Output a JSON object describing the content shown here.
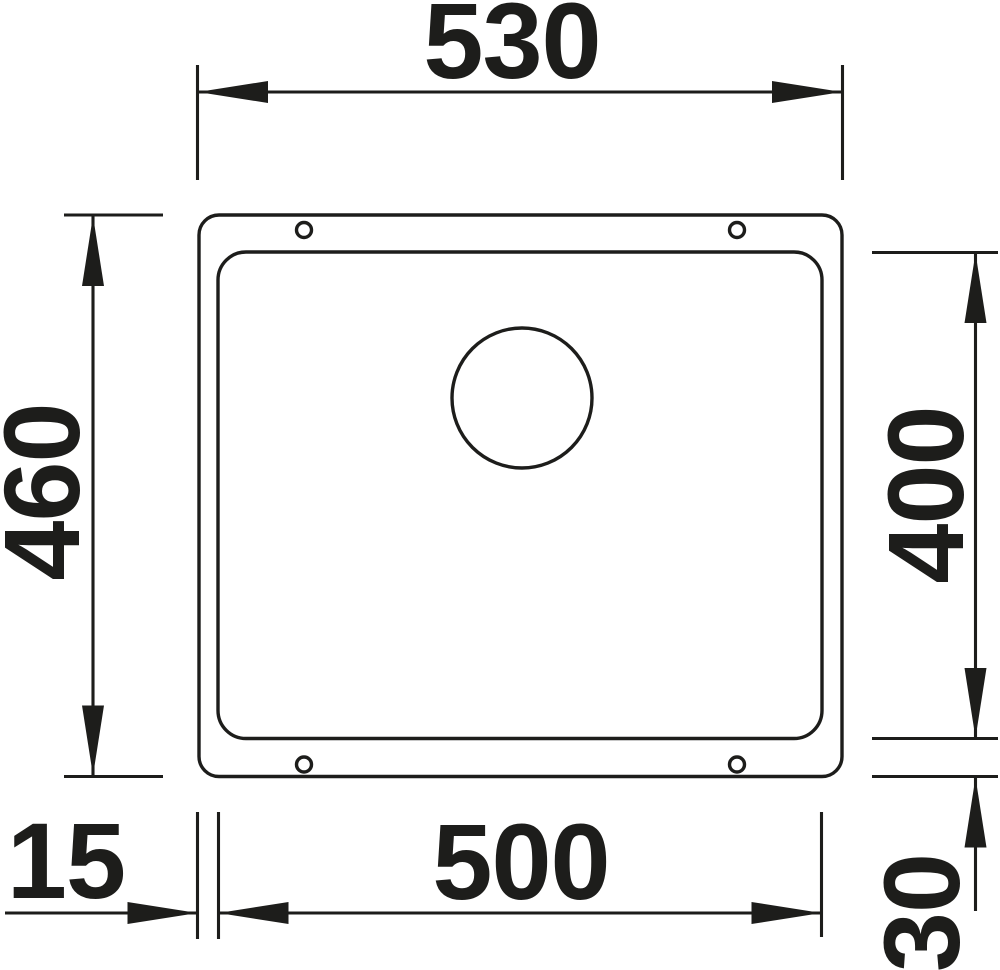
{
  "diagram": {
    "kind": "technical-dimension-drawing",
    "subject": "rectangular sink with bowl and drain, top view",
    "colors": {
      "line": "#1d1d1b",
      "background": "#ffffff"
    },
    "dimensions": {
      "outer_width": {
        "label": "530",
        "orientation": "horizontal",
        "position": "top"
      },
      "outer_height": {
        "label": "460",
        "orientation": "vertical",
        "position": "left"
      },
      "bowl_height": {
        "label": "400",
        "orientation": "vertical",
        "position": "right"
      },
      "bowl_width": {
        "label": "500",
        "orientation": "horizontal",
        "position": "bottom"
      },
      "rim_offset_left": {
        "label": "15",
        "orientation": "horizontal",
        "position": "bottom-left"
      },
      "rim_offset_bottom": {
        "label": "30",
        "orientation": "vertical",
        "position": "bottom-right"
      }
    },
    "features": {
      "drain_hole": "circle upper-center of bowl",
      "mounting_holes": 4
    }
  }
}
